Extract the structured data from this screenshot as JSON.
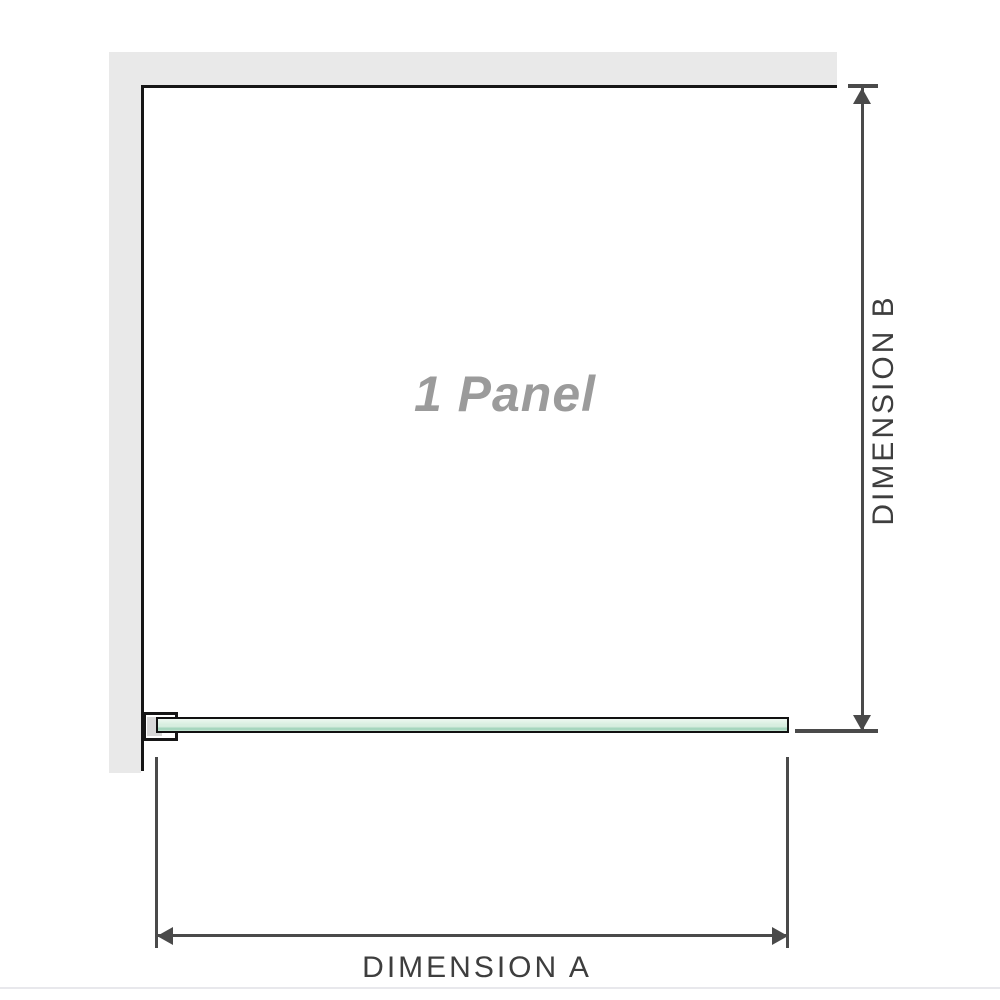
{
  "diagram": {
    "panel_label": "1 Panel",
    "dimension_a_label": "DIMENSION A",
    "dimension_b_label": "DIMENSION B"
  },
  "colors": {
    "wall": "#e9e9e9",
    "outline": "#161616",
    "dim": "#4a4a4a",
    "dim-text": "#3e3e3e",
    "label-gray": "#9b9b9b",
    "glass-border": "#111111",
    "glass-top": "#eef8f1",
    "glass-mid": "#d8eee0",
    "glass-stripe": "#a5d5bd",
    "glass-bottom": "#cbe7d6",
    "bracket-pad": "#d7d7d7",
    "divider": "#e8e8ec"
  }
}
